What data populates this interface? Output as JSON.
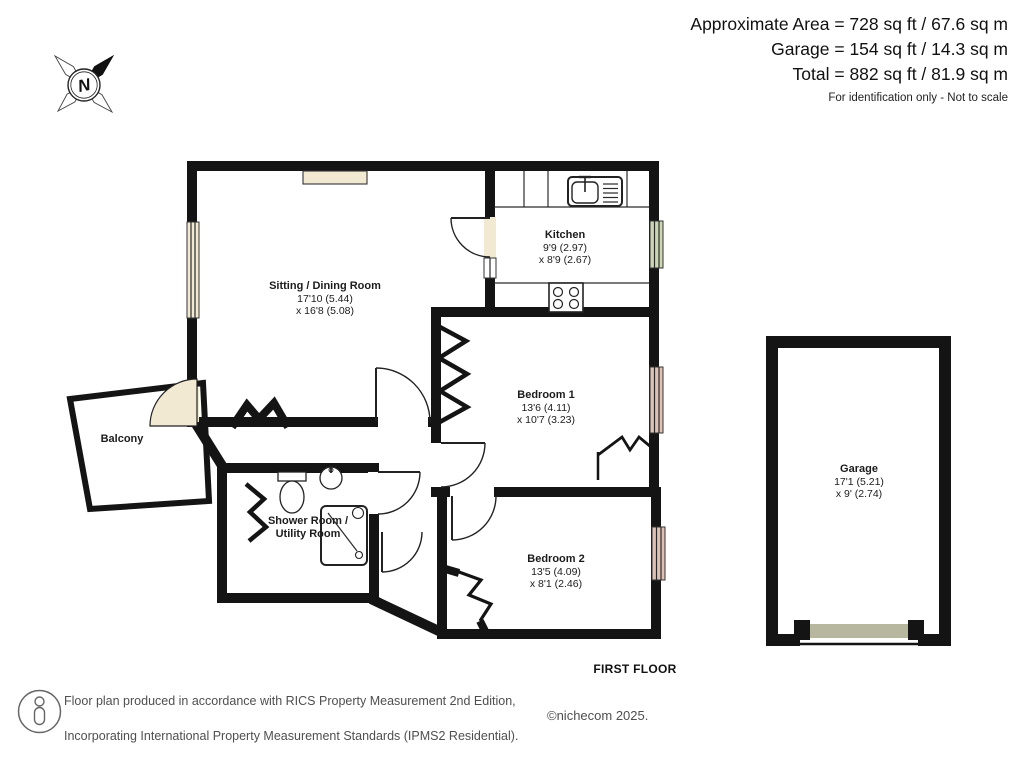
{
  "header": {
    "line1": "Approximate Area = 728 sq ft / 67.6 sq m",
    "line2": "Garage = 154 sq ft / 14.3 sq m",
    "line3": "Total = 882 sq ft / 81.9 sq m",
    "disclaimer": "For identification only - Not to scale"
  },
  "compass": {
    "letter": "N"
  },
  "rooms": {
    "sitting": {
      "name": "Sitting / Dining Room",
      "dim1": "17'10 (5.44)",
      "dim2": "x 16'8 (5.08)"
    },
    "kitchen": {
      "name": "Kitchen",
      "dim1": "9'9 (2.97)",
      "dim2": "x 8'9 (2.67)"
    },
    "bedroom1": {
      "name": "Bedroom 1",
      "dim1": "13'6 (4.11)",
      "dim2": "x 10'7 (3.23)"
    },
    "bedroom2": {
      "name": "Bedroom 2",
      "dim1": "13'5 (4.09)",
      "dim2": "x 8'1 (2.46)"
    },
    "shower": {
      "name_line1": "Shower Room /",
      "name_line2": "Utility Room"
    },
    "balcony": {
      "name": "Balcony"
    },
    "garage": {
      "name": "Garage",
      "dim1": "17'1 (5.21)",
      "dim2": "x 9' (2.74)"
    }
  },
  "floor_label": "FIRST FLOOR",
  "footer": {
    "line1": "Floor plan produced in accordance with RICS Property Measurement 2nd Edition,",
    "line2": "Incorporating International Property Measurement Standards (IPMS2 Residential).",
    "line3": "Produced for Michael Graham Estate Agents.   REF: 1319222",
    "copyright": "©nichecom 2025."
  },
  "colors": {
    "wall": "#141414",
    "sitting_room": "#f2e9d2",
    "kitchen": "#ccd6b5",
    "bedroom": "#dcc1b4",
    "shower_room": "#adbeb6",
    "garage": "#b6b79e",
    "balcony": "#ffffff",
    "footer_text": "#4f4f4f"
  }
}
